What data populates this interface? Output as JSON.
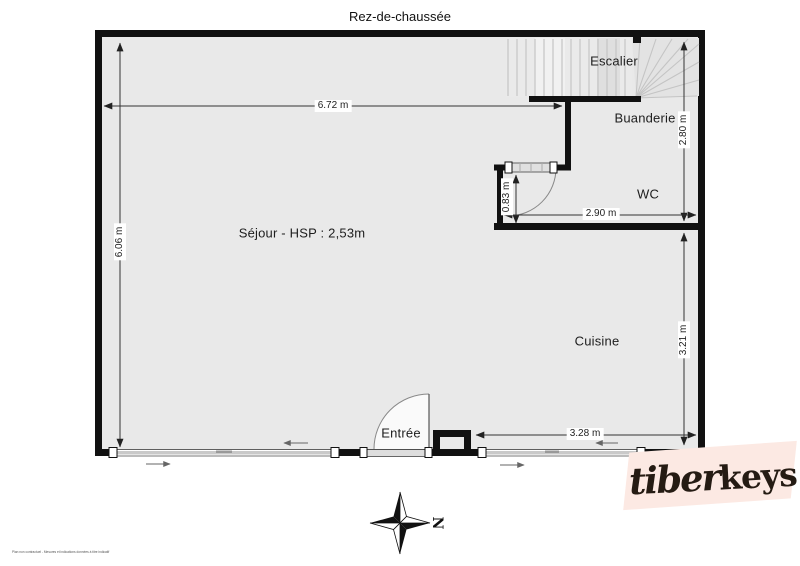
{
  "title": "Rez-de-chaussée",
  "rooms": {
    "escalier": "Escalier",
    "buanderie": "Buanderie",
    "wc": "WC",
    "sejour": "Séjour - HSP : 2,53m",
    "cuisine": "Cuisine",
    "entree": "Entrée"
  },
  "dimensions": {
    "sejour_width": "6.72 m",
    "left_height": "6.06 m",
    "right_upper_height": "2.80 m",
    "wc_door_width": "0.83 m",
    "wc_width": "2.90 m",
    "cuisine_height": "3.21 m",
    "cuisine_width": "3.28 m"
  },
  "compass": {
    "north_label": "N"
  },
  "logo": {
    "script_part": "tiber",
    "bold_part": "keys"
  },
  "footer": {
    "disclaimer": "Plan non contractuel - Mesures et indications données à titre indicatif"
  },
  "colors": {
    "wall": "#111111",
    "floor": "#e9e9e9",
    "dim_line": "#333333",
    "logo_bg": "#fce9e3",
    "logo_text": "#251b13"
  }
}
